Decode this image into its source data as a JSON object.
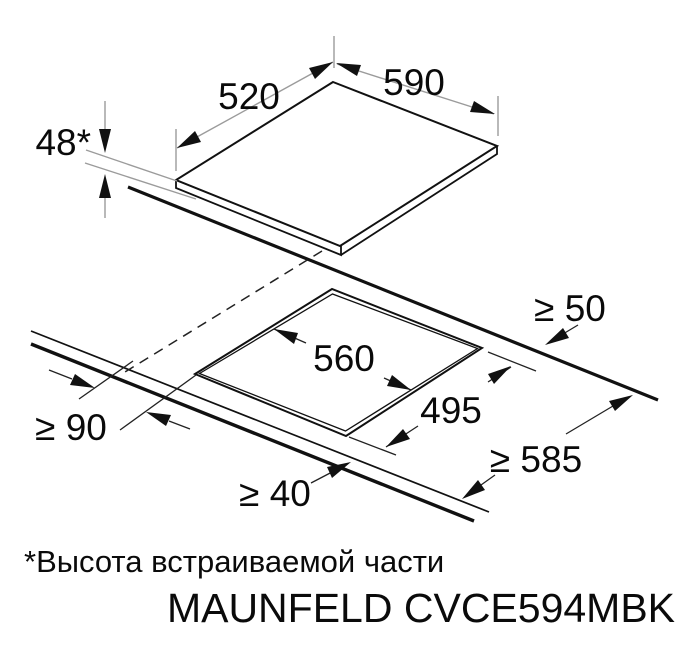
{
  "diagram": {
    "labels": {
      "builtin_height": "48*",
      "appliance_depth": "520",
      "appliance_width": "590",
      "cutout_width": "560",
      "cutout_depth": "495",
      "rear_clearance": "≥ 50",
      "side_clearance": "≥ 90",
      "front_clearance": "≥ 40",
      "worktop_depth": "≥ 585"
    },
    "footnote": "*Высота встраиваемой части",
    "model": "MAUNFELD CVCE594MBK",
    "colors": {
      "line": "#111111",
      "dim_gray": "#9b9b9b",
      "dim_dark": "#222222",
      "background": "#ffffff"
    }
  }
}
